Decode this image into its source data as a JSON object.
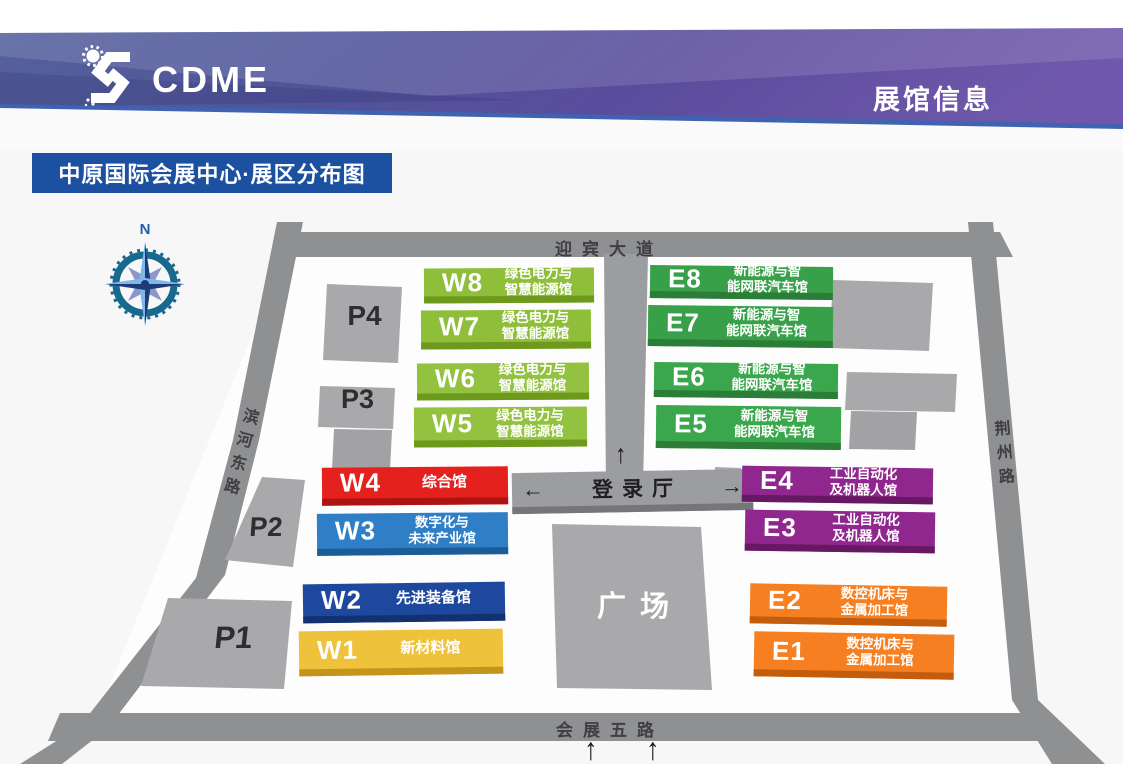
{
  "header": {
    "logo_text": "CDME",
    "page_title": "展馆信息"
  },
  "map": {
    "title": "中原国际会展中心·展区分布图",
    "compass": {
      "label": "N"
    },
    "roads": {
      "top": "迎宾大道",
      "left": "滨河东路",
      "right": "荆州路",
      "bottom": "会展五路"
    },
    "center": {
      "registration_hall": "登录厅",
      "left_arrow": "←",
      "right_arrow": "→",
      "road_up_arrow": "↑",
      "plaza": "广场"
    },
    "entrance_arrows": [
      "↑",
      "↑"
    ],
    "parking_lots": [
      {
        "id": "P1"
      },
      {
        "id": "P2"
      },
      {
        "id": "P3"
      },
      {
        "id": "P4"
      }
    ],
    "halls": [
      {
        "id": "W8",
        "name_lines": [
          "绿色电力与",
          "智慧能源馆"
        ],
        "color": "#8fbe3b",
        "side_color": "#6d9a1d"
      },
      {
        "id": "W7",
        "name_lines": [
          "绿色电力与",
          "智慧能源馆"
        ],
        "color": "#8fbe3b",
        "side_color": "#6d9a1d"
      },
      {
        "id": "W6",
        "name_lines": [
          "绿色电力与",
          "智慧能源馆"
        ],
        "color": "#93c240",
        "side_color": "#6d9a1d"
      },
      {
        "id": "W5",
        "name_lines": [
          "绿色电力与",
          "智慧能源馆"
        ],
        "color": "#93c240",
        "side_color": "#6d9a1d"
      },
      {
        "id": "W4",
        "name_lines": [
          "综合馆"
        ],
        "color": "#e5211e",
        "side_color": "#ad1310"
      },
      {
        "id": "W3",
        "name_lines": [
          "数字化与",
          "未来产业馆"
        ],
        "color": "#2e7fc5",
        "side_color": "#1d5d97"
      },
      {
        "id": "W2",
        "name_lines": [
          "先进装备馆"
        ],
        "color": "#1e489e",
        "side_color": "#12316f"
      },
      {
        "id": "W1",
        "name_lines": [
          "新材料馆"
        ],
        "color": "#efc23b",
        "side_color": "#c4941b"
      },
      {
        "id": "E8",
        "name_lines": [
          "新能源与智",
          "能网联汽车馆"
        ],
        "color": "#38a049",
        "side_color": "#2b7d38"
      },
      {
        "id": "E7",
        "name_lines": [
          "新能源与智",
          "能网联汽车馆"
        ],
        "color": "#38a049",
        "side_color": "#2b7d38"
      },
      {
        "id": "E6",
        "name_lines": [
          "新能源与智",
          "能网联汽车馆"
        ],
        "color": "#3ba74d",
        "side_color": "#2b7d38"
      },
      {
        "id": "E5",
        "name_lines": [
          "新能源与智",
          "能网联汽车馆"
        ],
        "color": "#3ba74d",
        "side_color": "#2b7d38"
      },
      {
        "id": "E4",
        "name_lines": [
          "工业自动化",
          "及机器人馆"
        ],
        "color": "#90278e",
        "side_color": "#671863"
      },
      {
        "id": "E3",
        "name_lines": [
          "工业自动化",
          "及机器人馆"
        ],
        "color": "#90278e",
        "side_color": "#671863"
      },
      {
        "id": "E2",
        "name_lines": [
          "数控机床与",
          "金属加工馆"
        ],
        "color": "#f57f21",
        "side_color": "#c45c0d"
      },
      {
        "id": "E1",
        "name_lines": [
          "数控机床与",
          "金属加工馆"
        ],
        "color": "#f57f21",
        "side_color": "#c45c0d"
      }
    ]
  },
  "colors": {
    "banner_blue": "#51609e",
    "banner_purple": "#6a53a6",
    "banner_edge_blue": "#3f63b0",
    "title_badge_bg": "#1c50a1",
    "road_gray": "#8f9092",
    "building_gray": "#a9a9ab",
    "plaza_gray": "#a9a9ab",
    "registration_bar_gray": "#9c9da0"
  }
}
